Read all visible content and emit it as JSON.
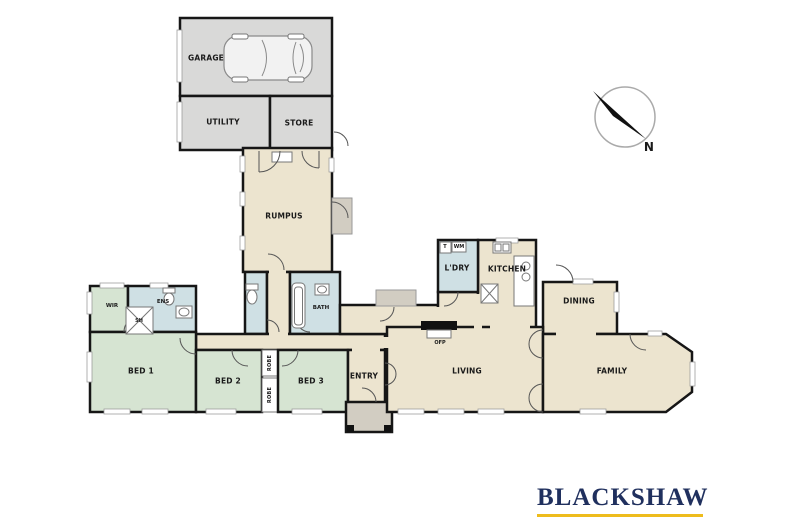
{
  "palette": {
    "wall": "#161616",
    "garage_fill": "#d9d9d8",
    "hall_fill": "#ece4cf",
    "bedroom_fill": "#d6e4d2",
    "wet_area_fill": "#cfe0e4",
    "porch_fill": "#d2cdc2",
    "logo_navy": "#20305e",
    "logo_gold": "#eebc1c"
  },
  "rooms": {
    "garage": "GARAGE",
    "utility": "UTILITY",
    "store": "STORE",
    "rumpus": "RUMPUS",
    "laundry": "L'DRY",
    "kitchen": "KITCHEN",
    "dining": "DINING",
    "family": "FAMILY",
    "living": "LIVING",
    "entry": "ENTRY",
    "bed1": "BED 1",
    "bed2": "BED 2",
    "bed3": "BED 3",
    "bath": "BATH",
    "ensuite": "ENS",
    "wir": "WIR",
    "robe": "ROBE"
  },
  "fixtures": {
    "washing_machine": "WM",
    "laundry_tub": "T",
    "shower": "SH",
    "fireplace": "OFP"
  },
  "compass": {
    "label": "N"
  },
  "logo": {
    "text": "BLACKSHAW"
  }
}
